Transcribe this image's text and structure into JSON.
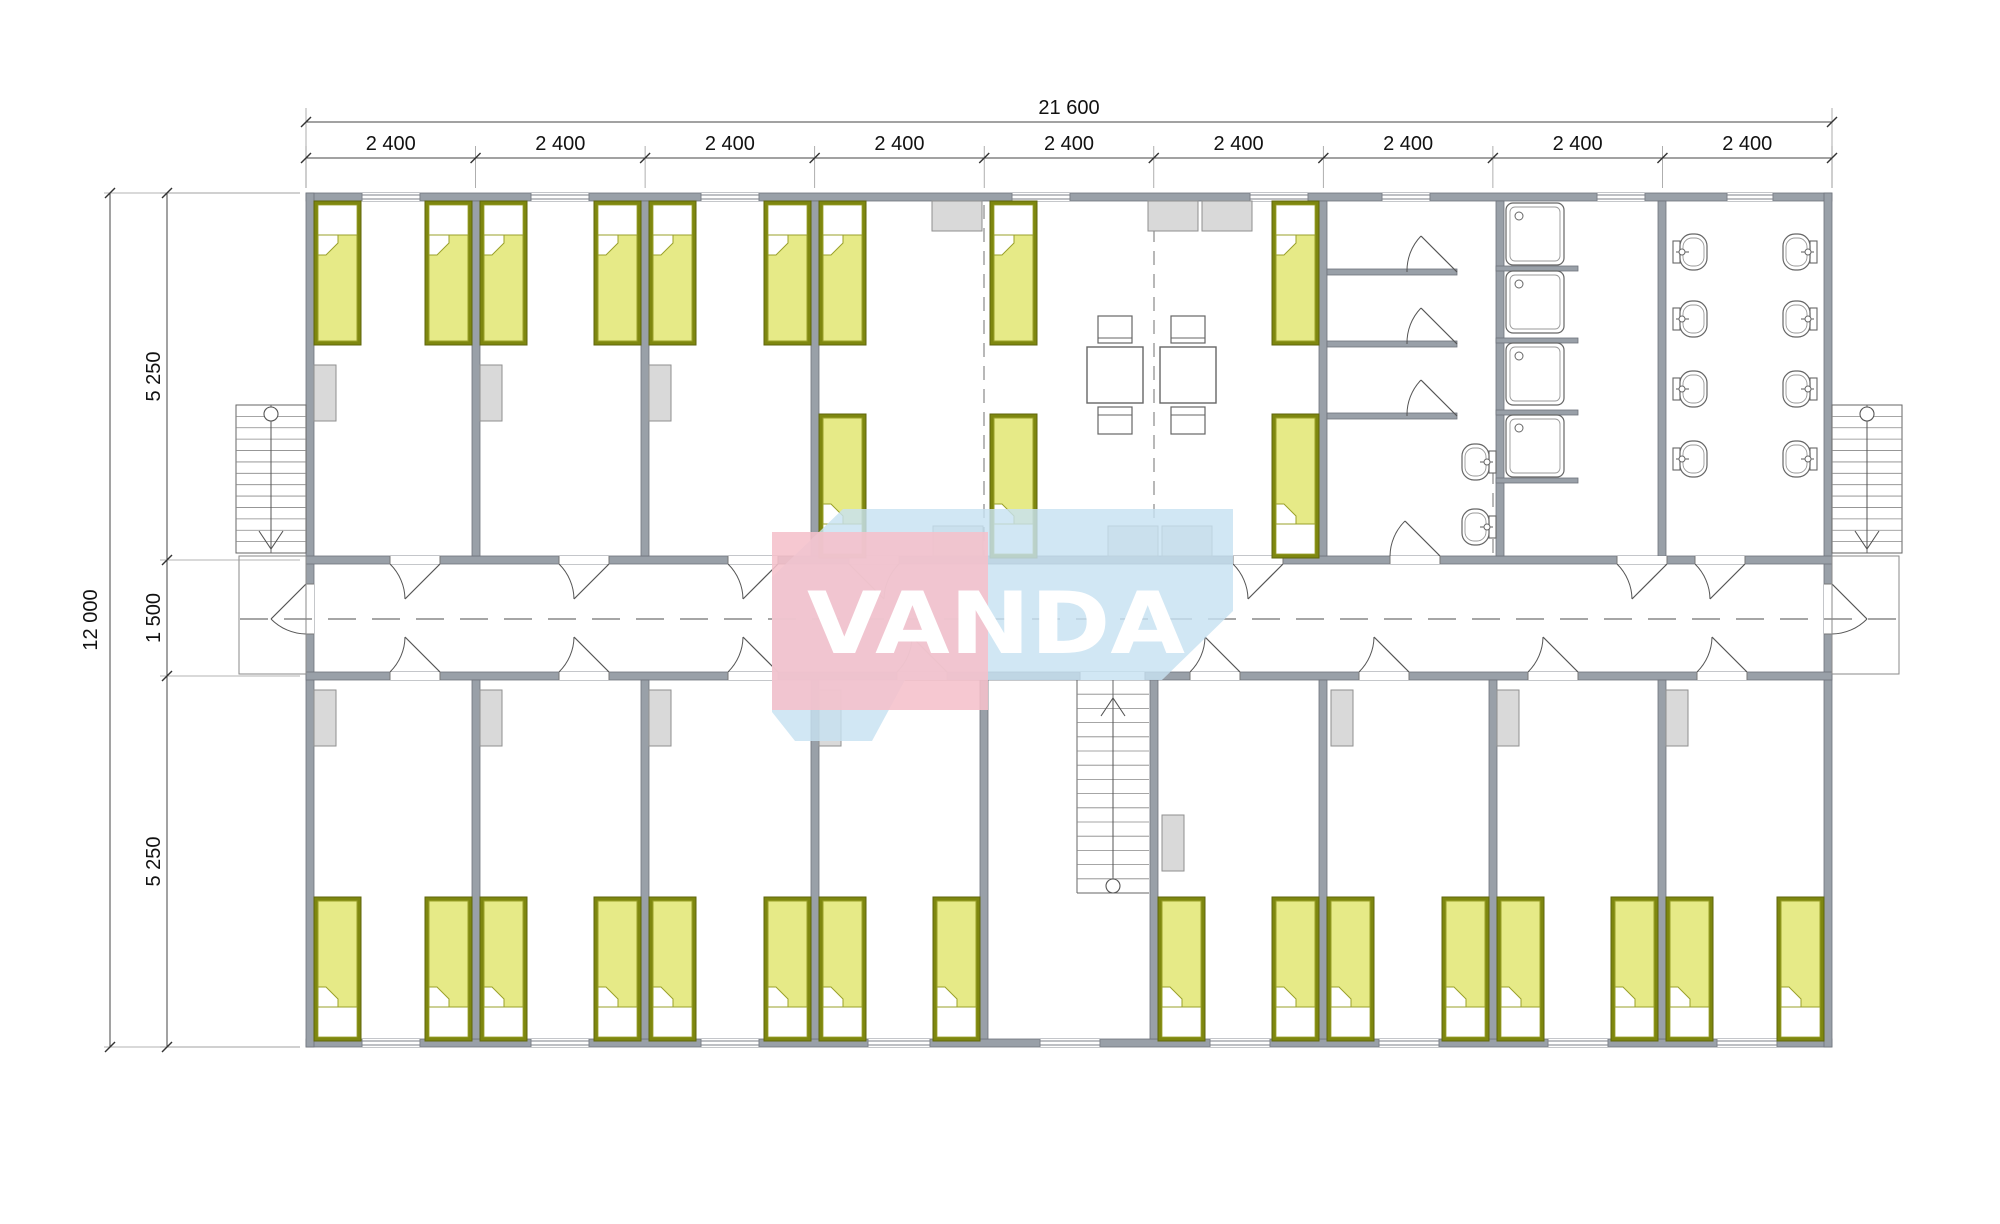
{
  "page": {
    "background": "#ffffff",
    "drawing_type": "dormitory-floor-plan"
  },
  "watermark": {
    "text": "VANDA",
    "blue": "#c7e2f2",
    "pink": "#f5c0cb",
    "text_color": "#ffffff"
  },
  "dimensions": {
    "top": {
      "total": "21 600",
      "bays": [
        "2 400",
        "2 400",
        "2 400",
        "2 400",
        "2 400",
        "2 400",
        "2 400",
        "2 400",
        "2 400"
      ]
    },
    "left": {
      "total": "12 000",
      "segments": [
        "5 250",
        "1 500",
        "5 250"
      ]
    }
  },
  "colors": {
    "wall": "#99a0a8",
    "wall_stroke": "#6e737c",
    "bed_frame": "#7e870f",
    "mattress": "#e6ea87",
    "mattress_stroke": "#9aa02a",
    "furniture": "#d9d9d9",
    "furniture_stroke": "#8f8f8f",
    "line": "#555555",
    "dim_line": "#444444",
    "ext_line": "#9a9a9a",
    "dash": "#888888"
  },
  "plan": {
    "building": {
      "x": 306,
      "y": 193,
      "w": 1526,
      "h": 854,
      "wall": 8
    },
    "corridor": {
      "top_wall_y": 556,
      "bottom_wall_y": 672,
      "center_y": 619
    },
    "partitions_upper": [
      476,
      645,
      815,
      1323,
      1662,
      1500
    ],
    "partitions_lower": [
      476,
      645,
      815,
      984,
      1154,
      1323,
      1493,
      1662
    ],
    "beds": {
      "w": 47,
      "h": 144,
      "top_row": [
        314,
        425,
        480,
        594,
        649,
        764,
        819,
        990,
        1272
      ],
      "corridor_row": [
        819,
        990,
        1272
      ],
      "bottom_row": [
        314,
        425,
        480,
        594,
        649,
        764,
        819,
        933,
        1158,
        1272,
        1327,
        1442,
        1497,
        1611,
        1666,
        1777
      ]
    },
    "windows": {
      "top": [
        [
          362,
          58
        ],
        [
          531,
          58
        ],
        [
          701,
          58
        ],
        [
          1012,
          58
        ],
        [
          1250,
          58
        ],
        [
          1382,
          48
        ],
        [
          1597,
          48
        ],
        [
          1727,
          46
        ]
      ],
      "bottom": [
        [
          362,
          58
        ],
        [
          531,
          58
        ],
        [
          701,
          58
        ],
        [
          868,
          62
        ],
        [
          1040,
          60
        ],
        [
          1210,
          60
        ],
        [
          1379,
          60
        ],
        [
          1548,
          60
        ],
        [
          1717,
          60
        ]
      ]
    },
    "wardrobes": [
      [
        314,
        365
      ],
      [
        480,
        365
      ],
      [
        649,
        365
      ],
      [
        314,
        690
      ],
      [
        480,
        690
      ],
      [
        649,
        690
      ],
      [
        819,
        690
      ],
      [
        1162,
        815
      ],
      [
        1331,
        690
      ],
      [
        1497,
        690
      ],
      [
        1666,
        690
      ]
    ],
    "lockers": [
      [
        932,
        201
      ],
      [
        1148,
        201
      ],
      [
        1202,
        201
      ],
      [
        933,
        526
      ],
      [
        1108,
        526
      ],
      [
        1162,
        526
      ]
    ],
    "tables": {
      "xs": [
        1087,
        1160
      ],
      "y": 347,
      "size": 56
    },
    "doors_top": [
      {
        "gap": [
          390,
          440
        ],
        "hinge": "r"
      },
      {
        "gap": [
          559,
          609
        ],
        "hinge": "r"
      },
      {
        "gap": [
          728,
          778
        ],
        "hinge": "r"
      },
      {
        "gap": [
          849,
          899
        ],
        "hinge": "l"
      },
      {
        "gap": [
          1233,
          1283
        ],
        "hinge": "r"
      },
      {
        "gap": [
          1390,
          1440
        ],
        "hinge": "r",
        "swing": "in"
      },
      {
        "gap": [
          1617,
          1667
        ],
        "hinge": "r"
      },
      {
        "gap": [
          1695,
          1745
        ],
        "hinge": "r"
      }
    ],
    "doors_bottom": [
      {
        "gap": [
          390,
          440
        ]
      },
      {
        "gap": [
          559,
          609
        ]
      },
      {
        "gap": [
          728,
          778
        ]
      },
      {
        "gap": [
          897,
          947
        ]
      },
      {
        "gap": [
          1080,
          1145
        ],
        "open": true
      },
      {
        "gap": [
          1190,
          1240
        ]
      },
      {
        "gap": [
          1359,
          1409
        ]
      },
      {
        "gap": [
          1528,
          1578
        ]
      },
      {
        "gap": [
          1697,
          1747
        ]
      }
    ],
    "entrances": {
      "left_y": [
        584,
        634
      ],
      "right_y": [
        584,
        634
      ]
    },
    "washroom": {
      "cubicle_partitions_y": [
        269,
        341,
        413
      ],
      "cubicle_x": [
        1327,
        1457
      ],
      "showers": {
        "x": 1506,
        "w": 58,
        "h": 62,
        "ys": [
          203,
          271,
          343,
          415
        ]
      },
      "shower_stub_ys": [
        266,
        338,
        410,
        478
      ],
      "basins": [
        [
          1482,
          462
        ],
        [
          1482,
          527
        ]
      ]
    },
    "toilet_room": {
      "left_wall_x": 1666,
      "right_wall_x": 1824,
      "ys": [
        252,
        319,
        389,
        459
      ]
    },
    "stairs": {
      "left": {
        "x": 236,
        "y": 405,
        "w": 70,
        "h": 148,
        "rail": 271,
        "landing": [
          239,
          556,
          67,
          118
        ]
      },
      "right": {
        "x": 1832,
        "y": 405,
        "w": 70,
        "h": 148,
        "rail": 1867,
        "landing": [
          1832,
          556,
          67,
          118
        ]
      },
      "center": {
        "x": 1077,
        "y": 680,
        "w": 72,
        "h": 213,
        "divider": 1113
      }
    },
    "dashed_modules": [
      [
        984,
        205,
        556
      ],
      [
        1154,
        205,
        556
      ],
      [
        1493,
        470,
        556
      ]
    ]
  }
}
